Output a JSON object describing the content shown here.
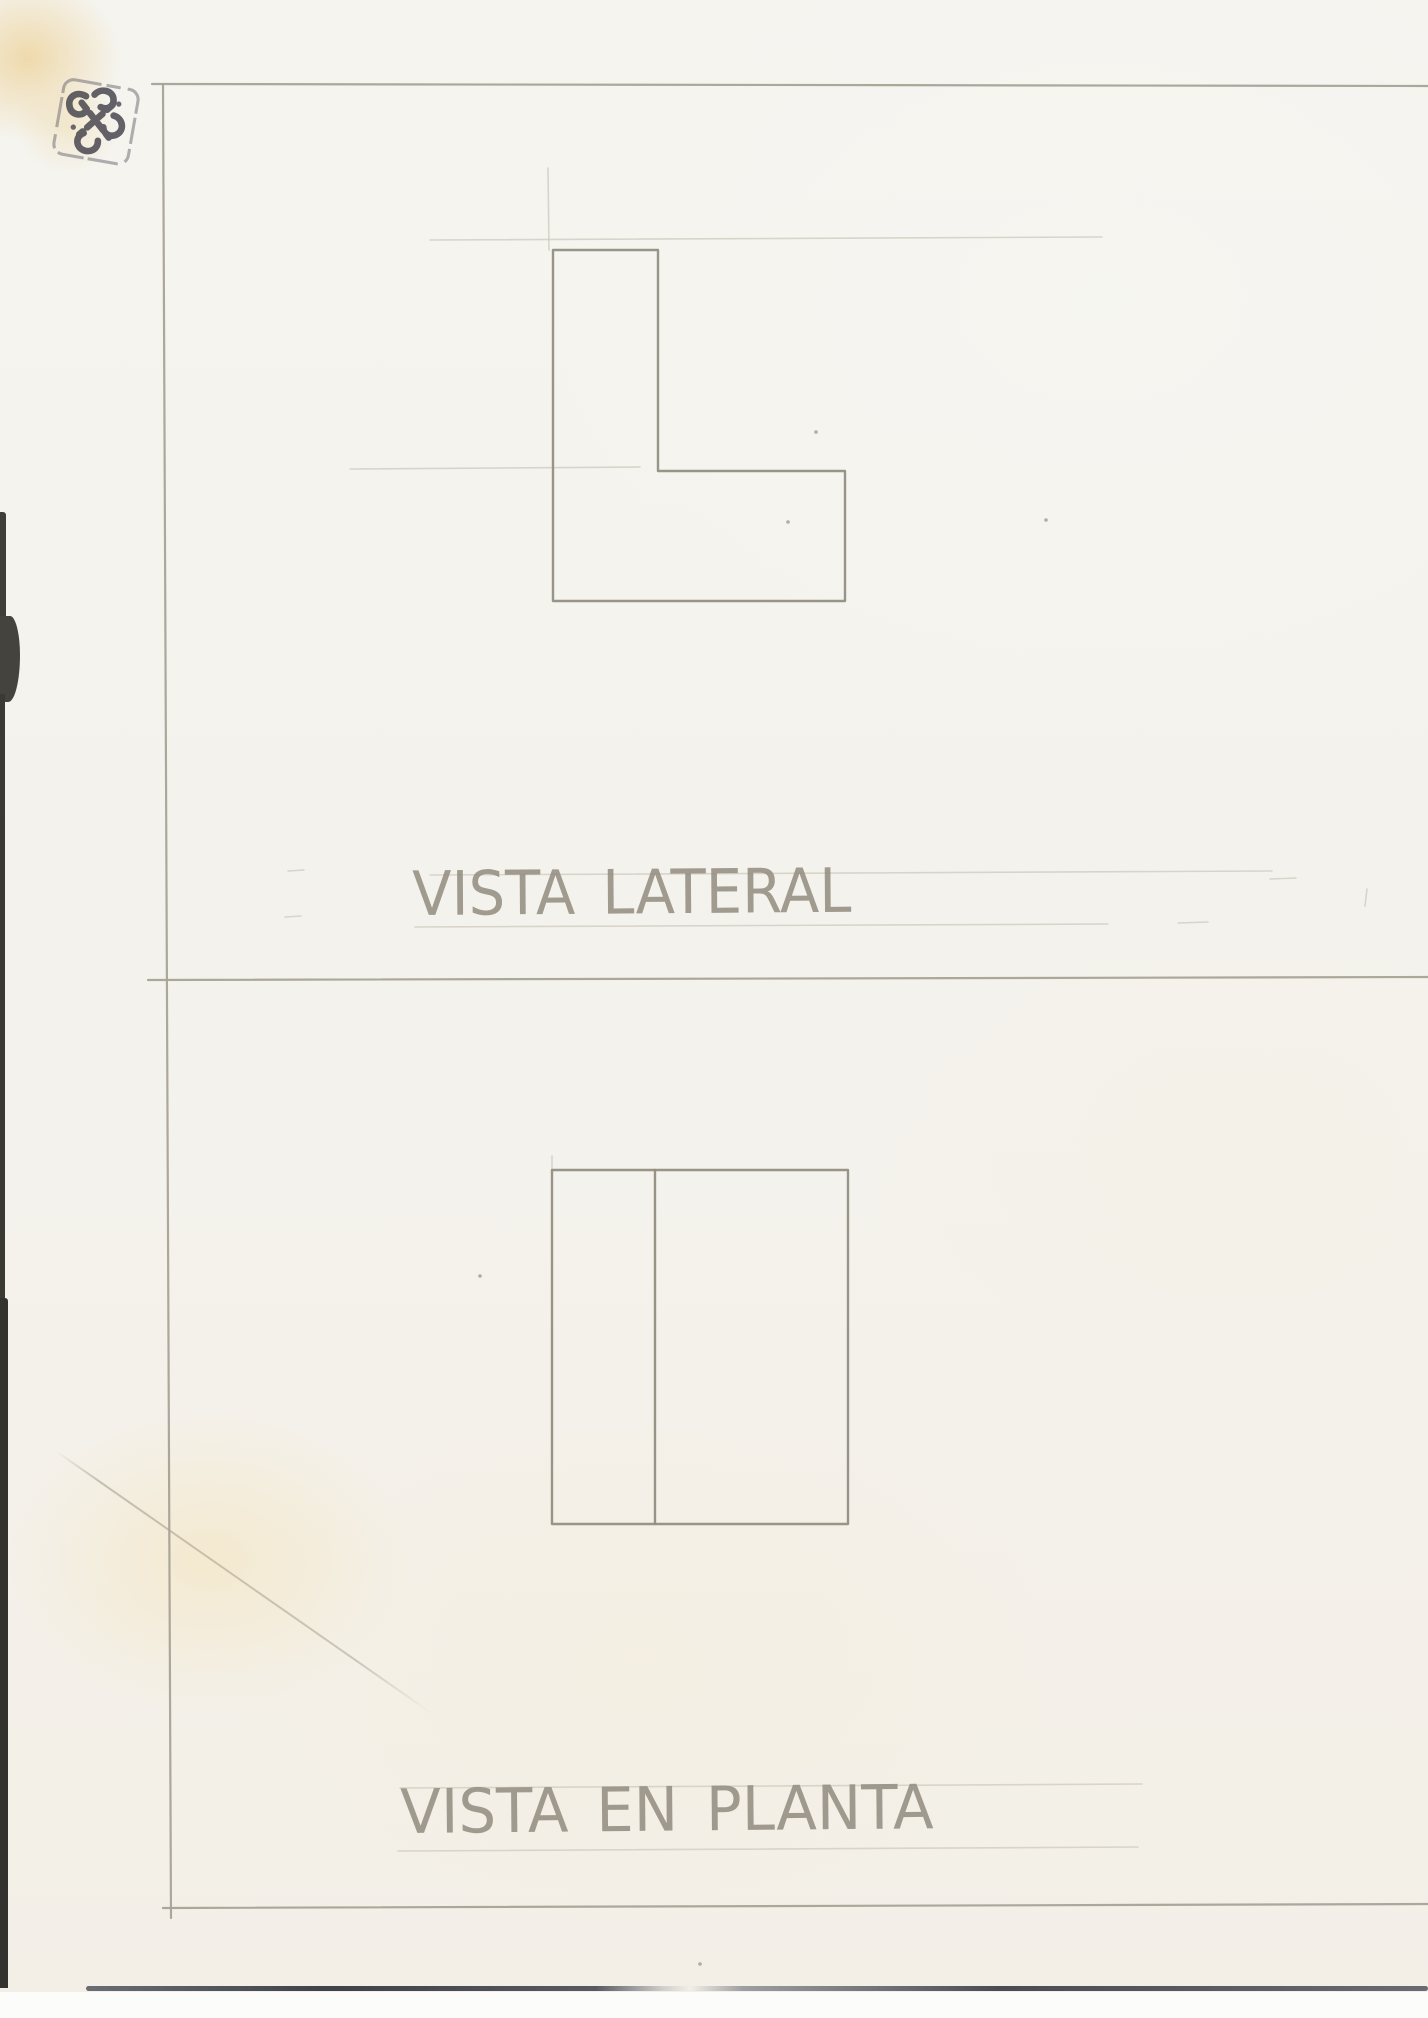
{
  "page": {
    "description": "Scanned hand-drawn pencil orthographic projection exercise on paper",
    "paper_color": "#f4f2ed",
    "pencil_color": "#948e82",
    "frame_color": "#a9a397",
    "faint_color": "#d3cdc1",
    "handwriting_color": "#968f84",
    "stamp_color": "#46454e"
  },
  "views": {
    "lateral": {
      "label": "VISTA LATERAL"
    },
    "planta": {
      "label": "VISTA EN PLANTA"
    }
  },
  "stamp": {
    "icon": "endless-knot-stamp"
  },
  "drawing": {
    "frame_lines": [
      [
        152,
        84,
        1428,
        86
      ],
      [
        163,
        84,
        171,
        1918
      ],
      [
        148,
        980,
        1428,
        977
      ],
      [
        163,
        1908,
        1428,
        1904
      ]
    ],
    "lateral_polygon": [
      [
        553,
        250
      ],
      [
        658,
        250
      ],
      [
        658,
        471
      ],
      [
        845,
        471
      ],
      [
        845,
        601
      ],
      [
        553,
        601
      ]
    ],
    "planta_rect": [
      552,
      1170,
      296,
      354
    ],
    "planta_divider": [
      655,
      1170,
      655,
      1524
    ],
    "guide_lines": [
      [
        430,
        240,
        1102,
        237
      ],
      [
        548,
        168,
        549,
        250
      ],
      [
        350,
        469,
        640,
        467
      ],
      [
        430,
        875,
        1272,
        871
      ],
      [
        415,
        927,
        1108,
        924
      ],
      [
        288,
        871,
        304,
        870
      ],
      [
        285,
        917,
        301,
        916
      ],
      [
        1270,
        879,
        1296,
        878
      ],
      [
        1178,
        923,
        1208,
        922
      ],
      [
        1367,
        889,
        1365,
        906
      ],
      [
        400,
        1788,
        1142,
        1784
      ],
      [
        398,
        1851,
        1138,
        1847
      ],
      [
        552,
        1156,
        552,
        1170
      ]
    ],
    "specks": [
      [
        788,
        522
      ],
      [
        816,
        432
      ],
      [
        700,
        1964
      ],
      [
        1046,
        520
      ],
      [
        480,
        1276
      ]
    ]
  }
}
